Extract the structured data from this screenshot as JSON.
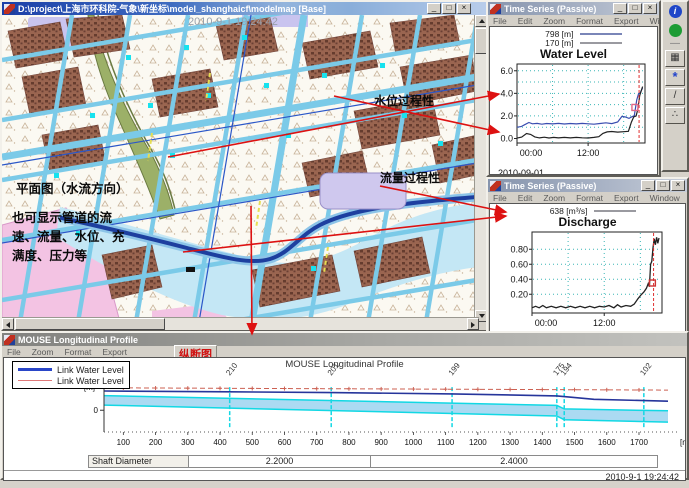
{
  "map_window": {
    "title": "D:\\project\\上海市环科院-气象\\新坐标\\model_shanghaicf\\modelmap [Base]",
    "map_timestamp": "2010-9-1 19:24:42",
    "labels": {
      "plan_view": "平面图（水流方向）",
      "note_lines": [
        "也可显示管道的流",
        "速、流量、水位、充",
        "满度、压力等"
      ],
      "water_level_process": "水位过程性",
      "discharge_process": "流量过程性"
    }
  },
  "chrome": {
    "minimize": "_",
    "maximize": "□",
    "close": "×"
  },
  "ts_windows": [
    {
      "title": "Time Series (Passive)",
      "menu": [
        "File",
        "Edit",
        "Zoom",
        "Format",
        "Export",
        "Window"
      ],
      "legend": [
        {
          "label": "798 [m]",
          "color": "#7a86b8",
          "thickness": 2
        },
        {
          "label": "170 [m]",
          "color": "#9a9aa0",
          "thickness": 2
        }
      ],
      "chart_title": "Water Level",
      "date": "2010-09-01"
    },
    {
      "title": "Time Series (Passive)",
      "menu": [
        "File",
        "Edit",
        "Zoom",
        "Format",
        "Export",
        "Window"
      ],
      "legend": [
        {
          "label": "638 [m³/s]",
          "color": "#9a9aa0",
          "thickness": 2
        }
      ],
      "chart_title": "Discharge",
      "date": "2010-09-01"
    }
  ],
  "toolbar": {
    "icons": [
      {
        "name": "info-icon",
        "glyph": "i",
        "style": "blue-disc"
      },
      {
        "name": "run-icon",
        "glyph": "",
        "style": "green-disc"
      },
      {
        "name": "separator",
        "glyph": "—",
        "style": "sep"
      },
      {
        "name": "select-grid-icon",
        "glyph": "▦",
        "style": "btn"
      },
      {
        "name": "splash-tool-icon",
        "glyph": "*",
        "style": "btn-blue"
      },
      {
        "name": "edit-profile-icon",
        "glyph": "/",
        "style": "btn"
      },
      {
        "name": "steps-tool-icon",
        "glyph": "∴",
        "style": "btn"
      }
    ]
  },
  "profile_window": {
    "title": "MOUSE Longitudinal Profile",
    "menu": [
      "File",
      "Zoom",
      "Format",
      "Export"
    ],
    "section_label": "纵断图",
    "legend": [
      {
        "label": "Link Water Level",
        "color": "#2a46c8",
        "thickness": 3
      },
      {
        "label": "Link Water Level",
        "color": "#e07878",
        "thickness": 1
      }
    ],
    "chart_title": "MOUSE Longitudinal Profile",
    "y_unit": "[m]",
    "y_zero": "0",
    "x_unit": "[m]",
    "shaft_label": "Shaft Diameter",
    "shaft_values": [
      "2.2000",
      "2.4000"
    ],
    "status_timestamp": "2010-9-1 19:24:42"
  },
  "chart_data": [
    {
      "type": "line",
      "window": "water-level",
      "title": "Water Level",
      "legend": [
        "798 [m]",
        "170 [m]"
      ],
      "date": "2010-09-01",
      "xlim": [
        0,
        21.6
      ],
      "ylim": [
        -0.4,
        6.6
      ],
      "x_ticks": [
        {
          "v": 0,
          "label": "00:00"
        },
        {
          "v": 12,
          "label": "12:00"
        }
      ],
      "y_ticks": [
        {
          "v": 0,
          "label": "0.0"
        },
        {
          "v": 2,
          "label": "2.0"
        },
        {
          "v": 4,
          "label": "4.0"
        },
        {
          "v": 6,
          "label": "6.0"
        }
      ],
      "grid_y": [
        1,
        2,
        3,
        4,
        5,
        6
      ],
      "grid_x": [
        6,
        12,
        18
      ],
      "series": [
        {
          "name": "798 [m]",
          "color": "#3a4db0",
          "width": 1.2,
          "points": [
            [
              0,
              1.0
            ],
            [
              0.7,
              1.05
            ],
            [
              1.3,
              1.22
            ],
            [
              2,
              1.42
            ],
            [
              2.6,
              1.3
            ],
            [
              3.4,
              1.34
            ],
            [
              4.2,
              1.27
            ],
            [
              5,
              1.33
            ],
            [
              6,
              1.29
            ],
            [
              7,
              1.34
            ],
            [
              8,
              1.28
            ],
            [
              9,
              1.33
            ],
            [
              10,
              1.29
            ],
            [
              11,
              1.34
            ],
            [
              12,
              1.3
            ],
            [
              13,
              1.27
            ],
            [
              14,
              1.33
            ],
            [
              15,
              1.39
            ],
            [
              16,
              1.32
            ],
            [
              17,
              1.46
            ],
            [
              17.7,
              1.96
            ],
            [
              18.3,
              1.9
            ],
            [
              18.9,
              1.78
            ],
            [
              19.4,
              1.93
            ],
            [
              19.8,
              2.02
            ],
            [
              20.2,
              3.4
            ],
            [
              20.5,
              3.95
            ],
            [
              20.8,
              4.05
            ],
            [
              21.2,
              4.5
            ]
          ]
        },
        {
          "name": "170 [m]",
          "color": "#222222",
          "width": 1.2,
          "points": [
            [
              0,
              0.03
            ],
            [
              0.8,
              0.12
            ],
            [
              1.6,
              0.44
            ],
            [
              2.3,
              0.36
            ],
            [
              3,
              0.14
            ],
            [
              3.8,
              0.05
            ],
            [
              4.6,
              0.11
            ],
            [
              5.4,
              0.04
            ],
            [
              6.2,
              0.1
            ],
            [
              7,
              0.05
            ],
            [
              8,
              0.1
            ],
            [
              9,
              0.05
            ],
            [
              10,
              0.1
            ],
            [
              11,
              0.06
            ],
            [
              12,
              0.04
            ],
            [
              13,
              0.1
            ],
            [
              13.8,
              0.16
            ],
            [
              14.5,
              0.45
            ],
            [
              15.2,
              0.58
            ],
            [
              16,
              0.62
            ],
            [
              17,
              0.57
            ],
            [
              18,
              0.6
            ],
            [
              18.8,
              0.64
            ],
            [
              19.3,
              1.45
            ],
            [
              19.7,
              1.9
            ],
            [
              20.1,
              2.0
            ],
            [
              20.4,
              2.6
            ],
            [
              20.7,
              3.8
            ],
            [
              21.2,
              4.6
            ]
          ]
        }
      ],
      "cursor_x": 20.6,
      "marker": {
        "x": 19.9,
        "y": 2.75,
        "color": "#e06888"
      }
    },
    {
      "type": "line",
      "window": "discharge",
      "title": "Discharge",
      "legend": [
        "638 [m³/s]"
      ],
      "date": "2010-09-01",
      "xlim": [
        0,
        21.6
      ],
      "ylim": [
        -0.05,
        1.03
      ],
      "x_ticks": [
        {
          "v": 0,
          "label": "00:00"
        },
        {
          "v": 12,
          "label": "12:00"
        }
      ],
      "y_ticks": [
        {
          "v": 0.2,
          "label": "0.20"
        },
        {
          "v": 0.4,
          "label": "0.40"
        },
        {
          "v": 0.6,
          "label": "0.60"
        },
        {
          "v": 0.8,
          "label": "0.80"
        }
      ],
      "grid_y": [
        0.2,
        0.4,
        0.6,
        0.8
      ],
      "grid_x": [
        6,
        12,
        18
      ],
      "series": [
        {
          "name": "638 [m³/s]",
          "color": "#222222",
          "width": 1.3,
          "points": [
            [
              0,
              0.02
            ],
            [
              0.6,
              0.04
            ],
            [
              1.2,
              0.02
            ],
            [
              1.8,
              0.05
            ],
            [
              2.4,
              0.02
            ],
            [
              3.2,
              0.04
            ],
            [
              4,
              0.02
            ],
            [
              4.8,
              0.04
            ],
            [
              5.6,
              0.02
            ],
            [
              6.4,
              0.04
            ],
            [
              7.2,
              0.02
            ],
            [
              8,
              0.04
            ],
            [
              8.8,
              0.02
            ],
            [
              9.6,
              0.04
            ],
            [
              10.4,
              0.02
            ],
            [
              11.2,
              0.04
            ],
            [
              12,
              0.03
            ],
            [
              12.8,
              0.05
            ],
            [
              13.6,
              0.02
            ],
            [
              14.2,
              0.06
            ],
            [
              14.8,
              0.03
            ],
            [
              15.6,
              0.05
            ],
            [
              16.4,
              0.04
            ],
            [
              17,
              0.07
            ],
            [
              17.6,
              0.14
            ],
            [
              18.1,
              0.19
            ],
            [
              18.6,
              0.23
            ],
            [
              19,
              0.28
            ],
            [
              19.3,
              0.34
            ],
            [
              19.5,
              0.3
            ],
            [
              19.7,
              0.6
            ],
            [
              19.9,
              0.64
            ],
            [
              20.1,
              0.82
            ],
            [
              20.3,
              0.94
            ],
            [
              20.5,
              0.86
            ],
            [
              20.7,
              0.96
            ],
            [
              20.9,
              0.88
            ],
            [
              21.1,
              0.95
            ]
          ]
        }
      ],
      "cursor_x": 20.2,
      "marker": {
        "x": 20.0,
        "y": 0.35,
        "color": "#cc3333"
      }
    },
    {
      "type": "profile",
      "window": "longitudinal-profile",
      "title": "MOUSE Longitudinal Profile",
      "xlim": [
        40,
        1790
      ],
      "ylim": [
        -2.35,
        3.05
      ],
      "x_ticks": [
        100,
        200,
        300,
        400,
        500,
        600,
        700,
        800,
        900,
        1000,
        1100,
        1200,
        1300,
        1400,
        1500,
        1600,
        1700
      ],
      "nodes": [
        {
          "label": "210",
          "x": 430
        },
        {
          "label": "201",
          "x": 745
        },
        {
          "label": "199",
          "x": 1120
        },
        {
          "label": "175",
          "x": 1445
        },
        {
          "label": "194",
          "x": 1468
        },
        {
          "label": "102",
          "x": 1715
        }
      ],
      "red_line": [
        [
          40,
          2.42
        ],
        [
          1790,
          2.18
        ]
      ],
      "water_line": [
        [
          40,
          2.08
        ],
        [
          430,
          1.99
        ],
        [
          745,
          1.9
        ],
        [
          1120,
          1.76
        ],
        [
          1445,
          1.55
        ],
        [
          1480,
          1.44
        ],
        [
          1560,
          1.18
        ],
        [
          1790,
          0.98
        ]
      ],
      "pipe_top": [
        [
          40,
          1.58
        ],
        [
          1445,
          0.52
        ],
        [
          1468,
          0.14
        ],
        [
          1790,
          -0.06
        ]
      ],
      "pipe_bottom": [
        [
          40,
          0.56
        ],
        [
          1445,
          -0.62
        ],
        [
          1468,
          -1.02
        ],
        [
          1790,
          -1.28
        ]
      ]
    }
  ]
}
